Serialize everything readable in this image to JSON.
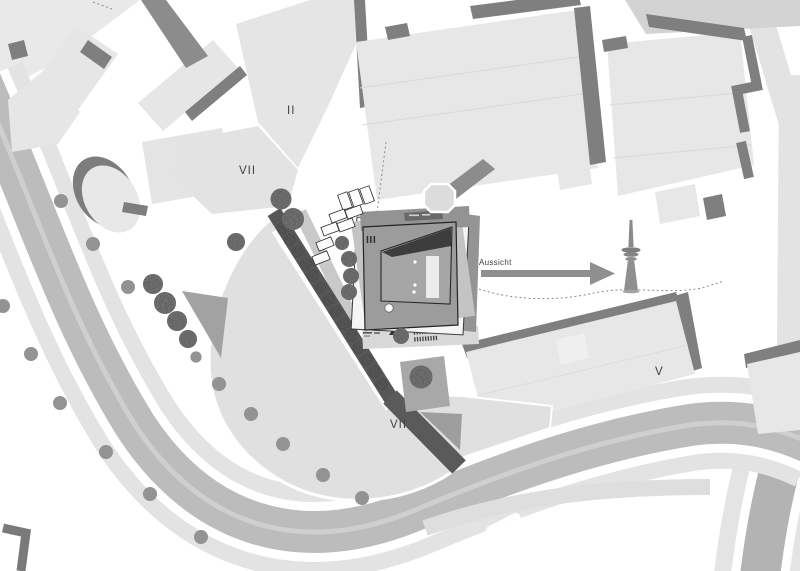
{
  "map": {
    "type": "architectural-site-plan",
    "labels": {
      "building_ii": "II",
      "building_vii_north": "VII",
      "main_building_iii": "III",
      "building_v": "V",
      "plaza_vii_south": "VII",
      "view_direction": "Aussicht"
    },
    "icons": {
      "tv_tower": "tv-tower-icon",
      "view_arrow": "arrow-right-icon",
      "entrance_marker": "triangle-marker-icon",
      "trees": "tree-icon"
    },
    "colors": {
      "background": "#ffffff",
      "building_fill": "#e6e6e6",
      "shadow_edge": "#7f7f7f",
      "road_major": "#bcbcbc",
      "road_minor": "#e3e3e3",
      "plaza": "#e0e0e0",
      "concrete_roof": "#9d9d9d",
      "stair_path": "#565656",
      "tree_dark": "#4a4a4a",
      "tree_light": "#939393",
      "label_text": "#3f3f3f"
    }
  }
}
